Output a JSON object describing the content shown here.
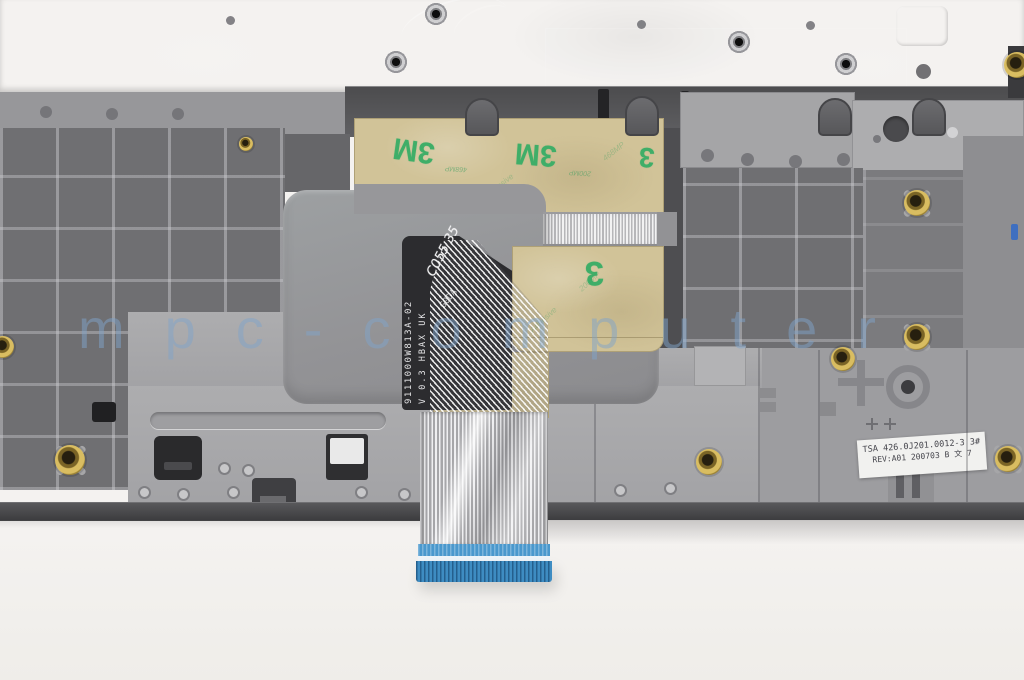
{
  "photo": {
    "watermark": "mpc-computer",
    "cable": {
      "part_number": "9111000W813A-02",
      "spec": "V 0.3 HBAX UK",
      "lot_code": "G0DA",
      "handwritten_mark": "C055 35"
    },
    "tape": {
      "brand": "3M",
      "brand_partial": "3",
      "liner_text_1": "468MP",
      "liner_text_2": "200MP",
      "liner_text_3": "Adhesive"
    },
    "part_label": {
      "line1": "TSA 426.0J201.0012-3 3#",
      "line2": "REV:A01 200703 B 文 7"
    },
    "colors": {
      "tape_tan": "#d1c398",
      "tape_green": "#3fae68",
      "connector_blue": "#4a98cd",
      "plastic_gray": "#6f6f72",
      "metal_gray": "#a9a9ab",
      "background": "#f3f1ef",
      "watermark_blue": "#80a4ca"
    }
  }
}
